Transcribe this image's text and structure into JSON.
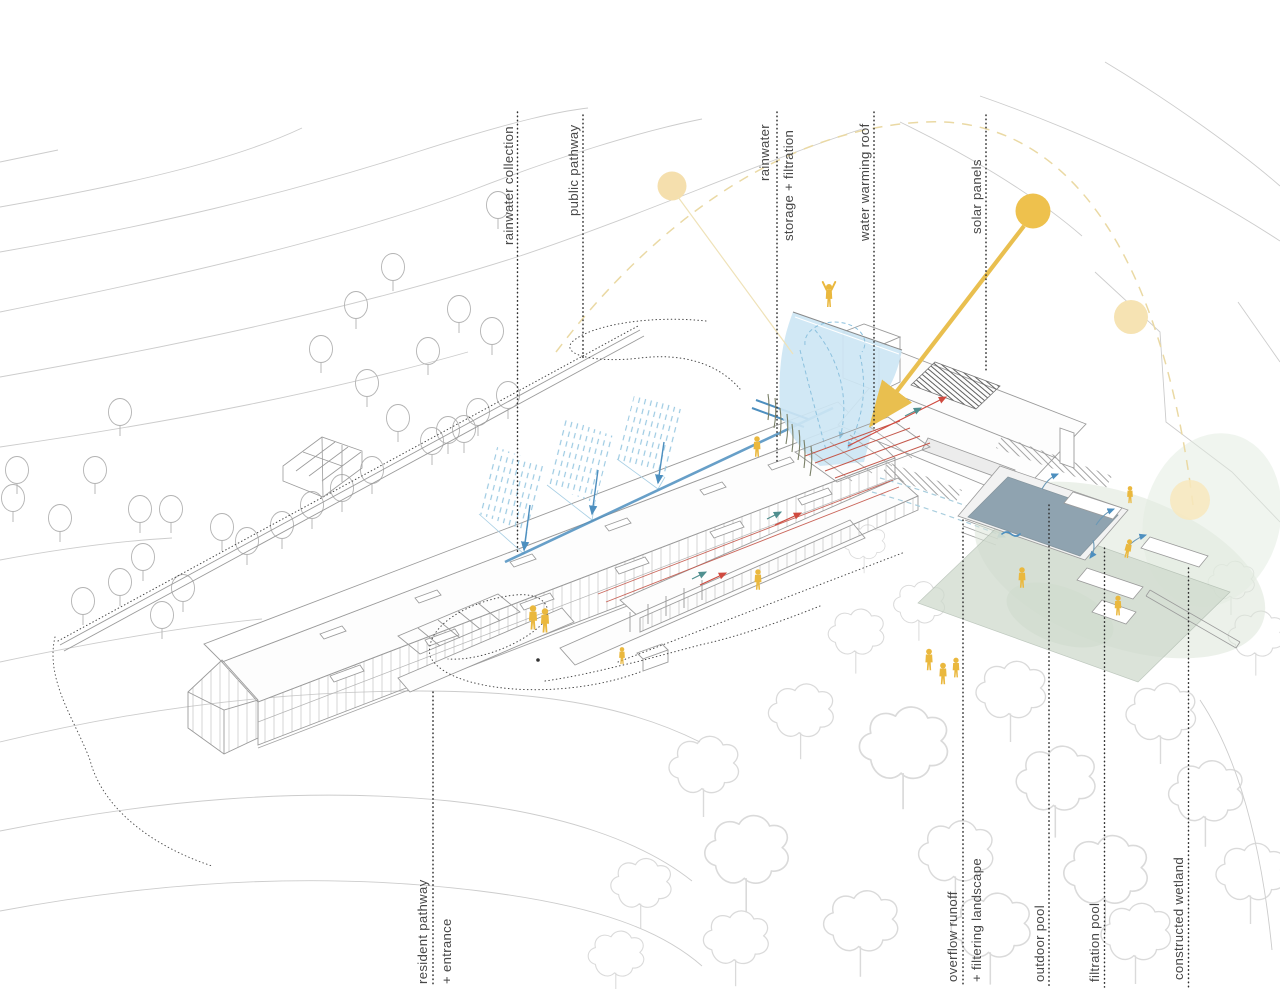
{
  "diagram": {
    "type": "architectural sustainability site axonometric",
    "background": "#ffffff"
  },
  "annotations": [
    {
      "id": "rainwater-collection",
      "side": "top",
      "lines": [
        "rainwater collection"
      ]
    },
    {
      "id": "public-pathway",
      "side": "top",
      "lines": [
        "public pathway"
      ]
    },
    {
      "id": "rainwater-storage-filtration",
      "side": "top",
      "lines": [
        "rainwater",
        "storage + filtration"
      ]
    },
    {
      "id": "water-warming-roof",
      "side": "top",
      "lines": [
        "water warming roof"
      ]
    },
    {
      "id": "solar-panels",
      "side": "top",
      "lines": [
        "solar panels"
      ]
    },
    {
      "id": "resident-pathway-entrance",
      "side": "bottom",
      "lines": [
        "resident pathway",
        "+ entrance"
      ]
    },
    {
      "id": "overflow-runoff-filtering-landscape",
      "side": "bottom",
      "lines": [
        "overflow runoff",
        "+ filtering landscape"
      ]
    },
    {
      "id": "outdoor-pool",
      "side": "bottom",
      "lines": [
        "outdoor pool"
      ]
    },
    {
      "id": "filtration-pool",
      "side": "bottom",
      "lines": [
        "filtration pool"
      ]
    },
    {
      "id": "constructed-wetland",
      "side": "bottom",
      "lines": [
        "constructed wetland"
      ]
    }
  ],
  "colors": {
    "sun": "#eec14d",
    "sun_faded": "#f5dfad",
    "sun_ray": "#e9bf4f",
    "sun_path_arc": "#ead9a4",
    "water_fill": "#cde6f4",
    "water_flow": "#8cc1de",
    "water_pipe": "#4d8fbf",
    "rain_hatch": "#9ccae2",
    "pipe_red": "#c4574a",
    "arrow_red": "#d04a3f",
    "arrow_teal": "#4f8f8f",
    "figure_yellow": "#eab83e",
    "pool_surface": "#8fa3b0",
    "terrace_green": "#cfdacd",
    "wetland_green": "#dce6d8",
    "contour_gray": "#cccccc",
    "building_line": "#9b9b9b",
    "forest_line": "#d4d4d4",
    "label_text": "#474747",
    "leader_dots": "#2f2f2f"
  }
}
